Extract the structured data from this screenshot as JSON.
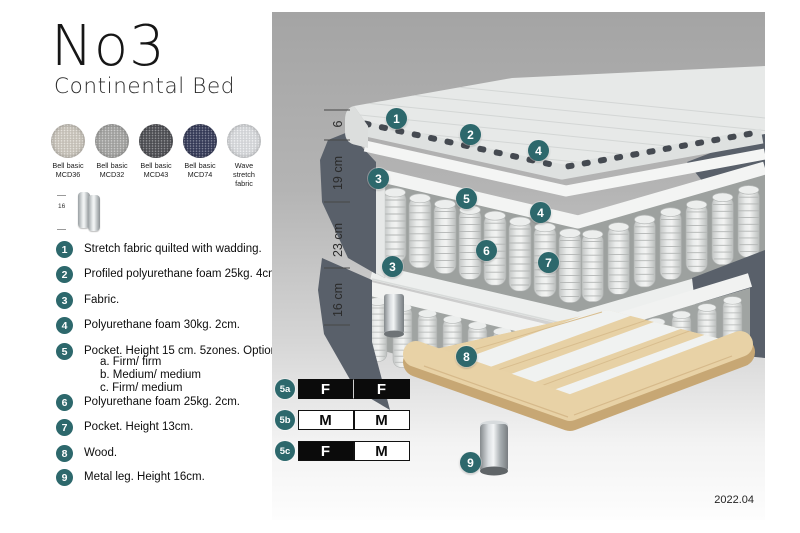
{
  "header": {
    "title": "No3",
    "subtitle": "Continental Bed"
  },
  "fabrics": [
    {
      "line1": "Bell basic",
      "line2": "MCD36",
      "color": "#d9d4ca"
    },
    {
      "line1": "Bell basic",
      "line2": "MCD32",
      "color": "#b0b0ae"
    },
    {
      "line1": "Bell basic",
      "line2": "MCD43",
      "color": "#54555a"
    },
    {
      "line1": "Bell basic",
      "line2": "MCD74",
      "color": "#3a4060"
    },
    {
      "line1": "Wave",
      "line2": "stretch fabric",
      "color": "#e8eaed"
    }
  ],
  "leg_thumb": {
    "dimension": "16"
  },
  "spec_list": [
    {
      "num": "1",
      "text": "Stretch fabric quilted with wadding."
    },
    {
      "num": "2",
      "text": "Profiled polyurethane foam 25kg. 4cm."
    },
    {
      "num": "3",
      "text": "Fabric."
    },
    {
      "num": "4",
      "text": "Polyurethane foam 30kg. 2cm."
    },
    {
      "num": "5",
      "text": "Pocket. Height 15 cm. 5zones. Option:",
      "options": [
        "a. Firm/ firm",
        "b. Medium/ medium",
        "c. Firm/ medium"
      ]
    },
    {
      "num": "6",
      "text": "Polyurethane foam 25kg. 2cm."
    },
    {
      "num": "7",
      "text": "Pocket. Height 13cm."
    },
    {
      "num": "8",
      "text": "Wood."
    },
    {
      "num": "9",
      "text": "Metal leg. Height 16cm."
    }
  ],
  "diagram": {
    "dimension_labels": [
      "6",
      "19 cm",
      "23 cm",
      "16 cm"
    ],
    "badges": [
      "1",
      "2",
      "4",
      "3",
      "5",
      "4",
      "6",
      "7",
      "3",
      "8",
      "9"
    ],
    "firmness": [
      {
        "id": "5a",
        "left": {
          "letter": "F",
          "variant": "dark"
        },
        "right": {
          "letter": "F",
          "variant": "dark"
        }
      },
      {
        "id": "5b",
        "left": {
          "letter": "M",
          "variant": "light"
        },
        "right": {
          "letter": "M",
          "variant": "light"
        }
      },
      {
        "id": "5c",
        "left": {
          "letter": "F",
          "variant": "dark"
        },
        "right": {
          "letter": "M",
          "variant": "light"
        }
      }
    ],
    "version": "2022.04"
  },
  "colors": {
    "accent_teal": "#2d686c",
    "side_fabric": "#59606a",
    "wood": "#e8d2a6",
    "photo_bg_top": "#a4a4a4"
  }
}
